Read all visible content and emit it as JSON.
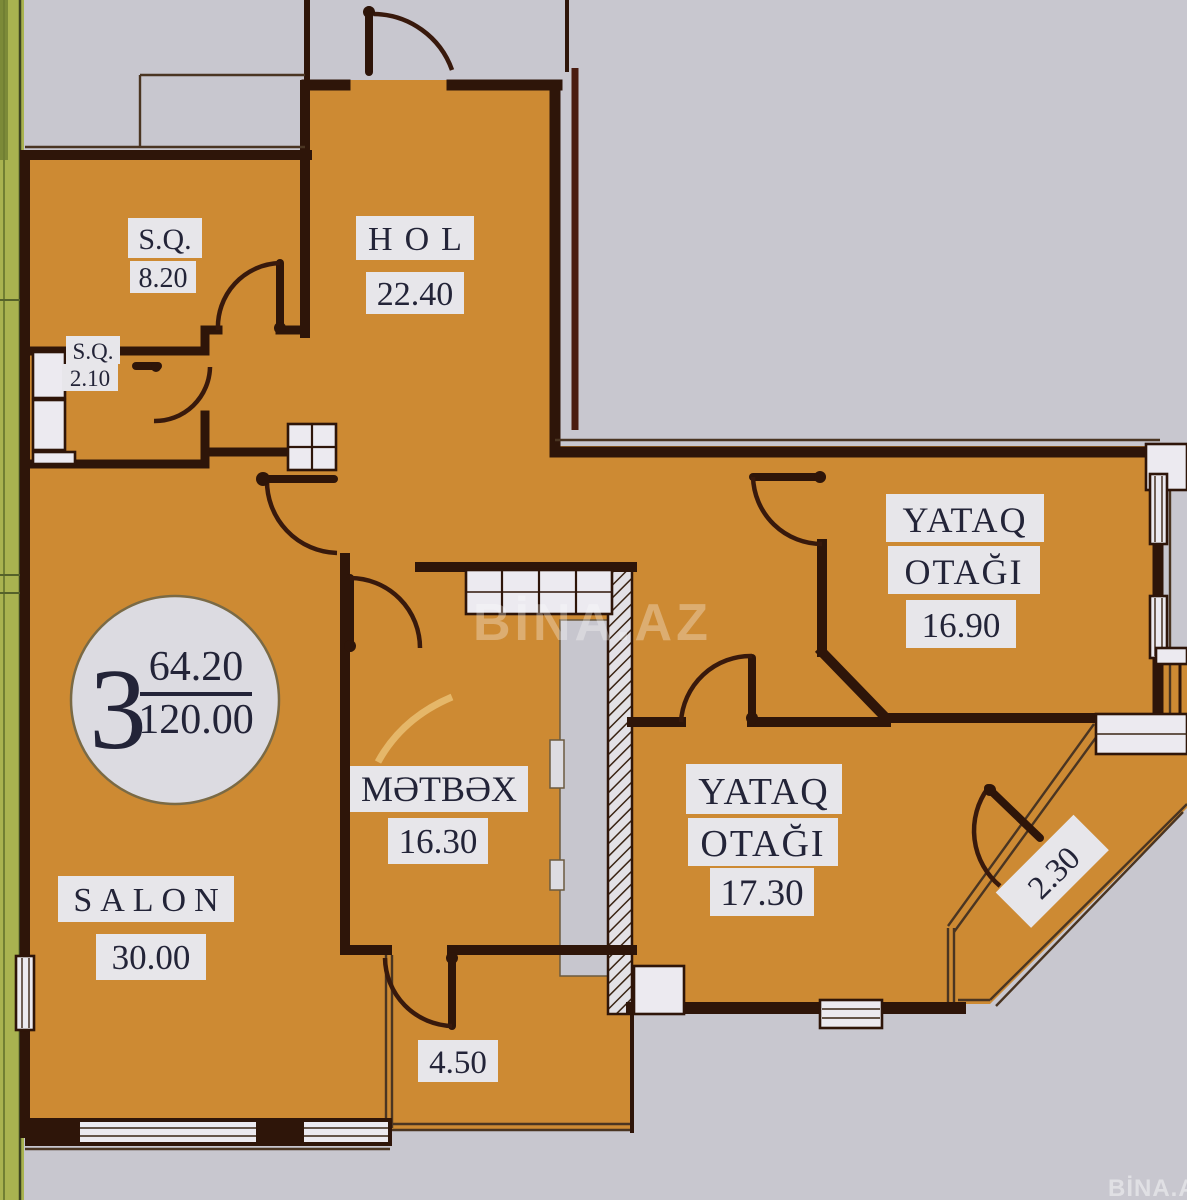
{
  "plan_type": "apartment-floor-plan",
  "unit_badge": {
    "room_count": "3",
    "area_living": "64.20",
    "area_total": "120.00"
  },
  "rooms": {
    "sq1": {
      "name": "S.Q.",
      "area": "8.20"
    },
    "sq2": {
      "name": "S.Q.",
      "area": "2.10"
    },
    "hol": {
      "name": "HOL",
      "area": "22.40"
    },
    "bedroom1": {
      "name_line1": "YATAQ",
      "name_line2": "OTAĞI",
      "area": "16.90"
    },
    "kitchen": {
      "name": "MƏTBƏX",
      "area": "16.30"
    },
    "bedroom2": {
      "name_line1": "YATAQ",
      "name_line2": "OTAĞI",
      "area": "17.30"
    },
    "salon": {
      "name": "SALON",
      "area": "30.00"
    },
    "balcony_bottom": {
      "area": "4.50"
    },
    "balcony_corner": {
      "area": "2.30"
    }
  },
  "watermark": {
    "center": "BİNA.AZ",
    "corner": "BİNA.AZ"
  },
  "colors": {
    "floor": "#cd8a33",
    "wall": "#2e1509",
    "background": "#c8c7cf",
    "label_bg": "#e7e6ea",
    "text": "#232438",
    "green_strip": "#a9b350",
    "neighbor_wall": "#4a1c10"
  }
}
